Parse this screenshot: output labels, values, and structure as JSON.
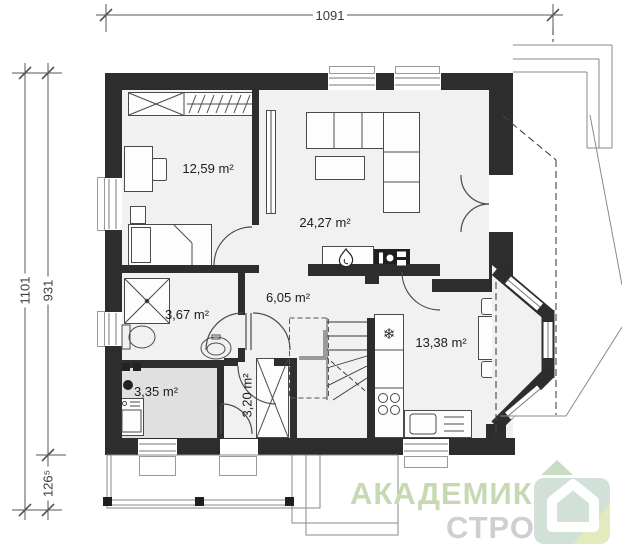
{
  "dimensions": {
    "top": "1091",
    "left_outer": "1101",
    "left_inner_upper": "931",
    "left_inner_lower": "126⁵"
  },
  "rooms": {
    "bedroom": {
      "area": "12,59 m²"
    },
    "living_room": {
      "area": "24,27 m²"
    },
    "bathroom": {
      "area": "3,67 m²"
    },
    "hall": {
      "area": "6,05 m²"
    },
    "boiler_room": {
      "area": "3,35 m²"
    },
    "entry": {
      "area": "3,20 m²"
    },
    "kitchen": {
      "area": "13,38 m²"
    }
  },
  "icons": {
    "fridge_snowflake": "❄"
  },
  "logo": {
    "line1": "АКАДЕМИК",
    "line2": "СТРОЙ"
  },
  "colors": {
    "wall": "#2d2d2d",
    "floor": "#f1f1f1",
    "boiler_floor": "#e0e0e0",
    "line": "#555555",
    "logo_text_green": "#c6d9b3",
    "logo_text_gray": "#cfcfd3",
    "logo_icon_green": "#d2e1d8",
    "logo_icon_fold": "#e1ebbd"
  }
}
